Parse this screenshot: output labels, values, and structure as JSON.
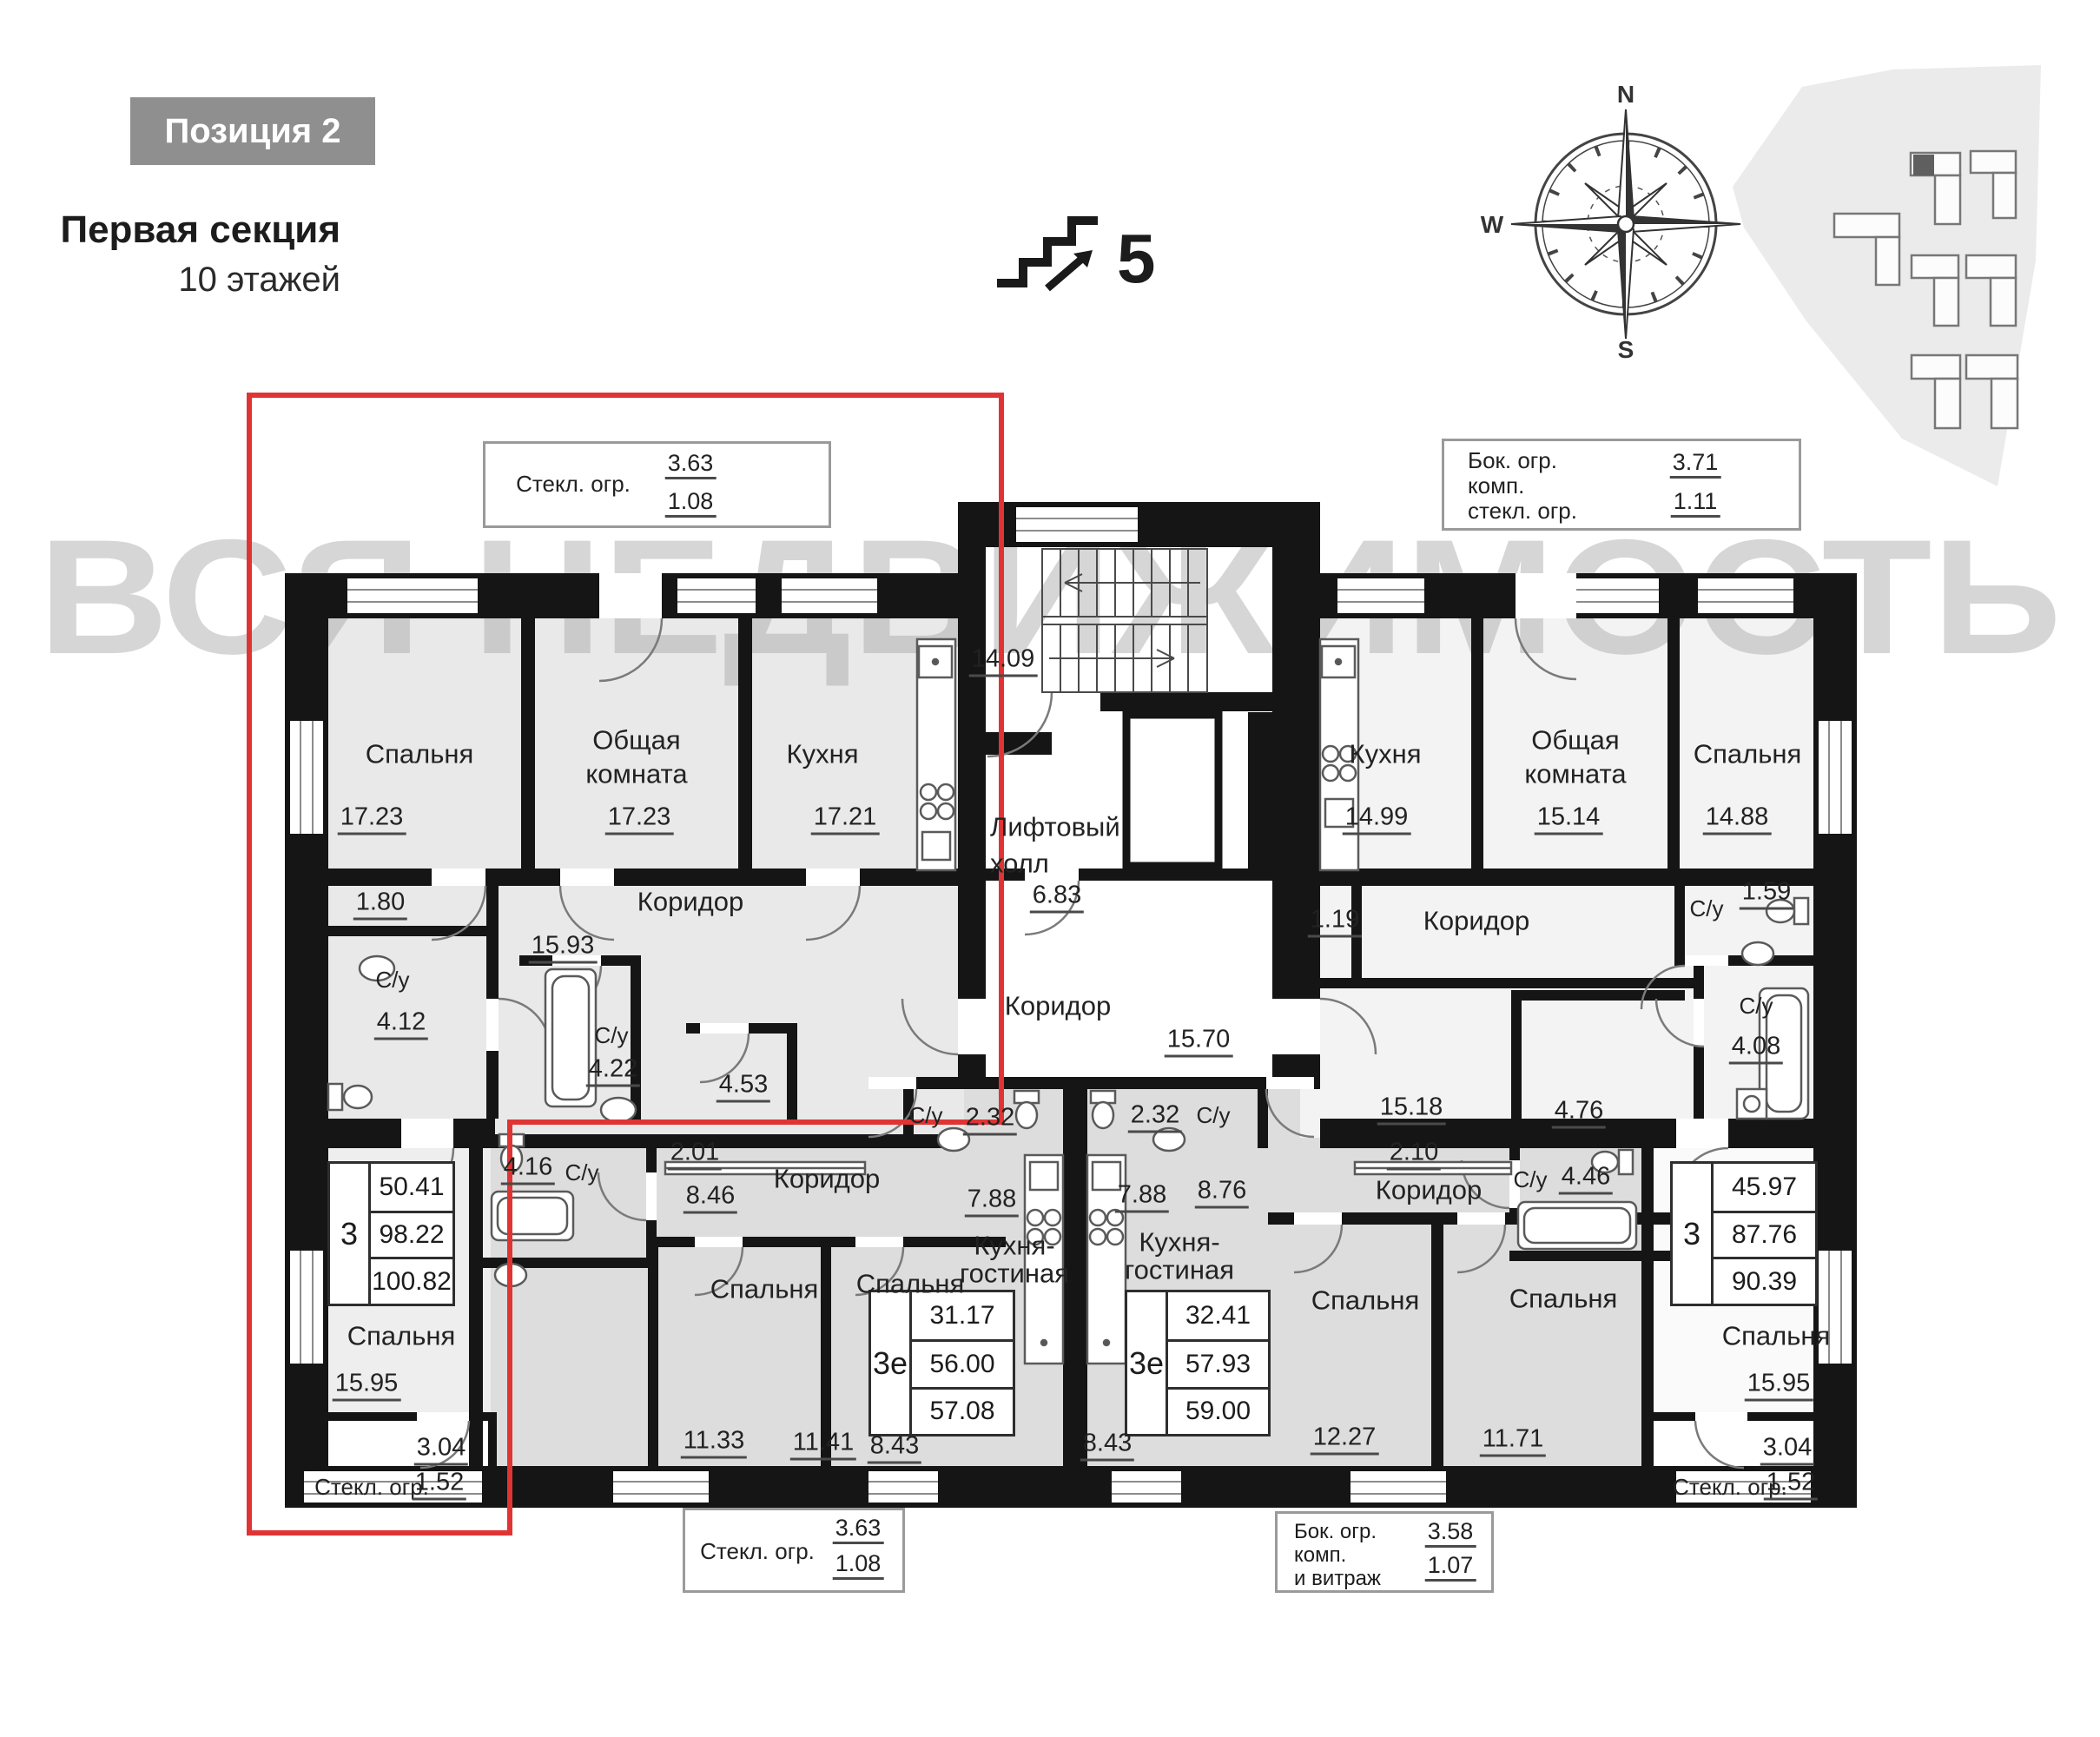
{
  "header": {
    "badge": "Позиция 2",
    "title": "Первая секция",
    "subtitle": "10 этажей",
    "floor": "5"
  },
  "compass": {
    "n": "N",
    "e": "E",
    "s": "S",
    "w": "W"
  },
  "watermark": "ВСЯ НЕДВИЖИМОСТЬ",
  "balconies": {
    "top_left": {
      "label": "Стекл. огр.",
      "top": "3.63",
      "bottom": "1.08"
    },
    "top_right": {
      "l1": "Бок. огр.",
      "l2": "комп.",
      "l3": "стекл. огр.",
      "top": "3.71",
      "bottom": "1.11"
    },
    "bottom_left": {
      "label": "Стекл. огр.",
      "top": "3.63",
      "bottom": "1.08"
    },
    "bottom_right": {
      "l1": "Бок. огр.",
      "l2": "комп.",
      "l3": "и витраж",
      "top": "3.58",
      "bottom": "1.07"
    },
    "apt_left": {
      "area": "3.04",
      "label": "Стекл. огр.",
      "glazed": "1.52"
    },
    "apt_right": {
      "area": "3.04",
      "label": "Стекл. огр.",
      "glazed": "1.52"
    }
  },
  "core": {
    "stairs_area": "14.09",
    "lift1": "Лифтовый",
    "lift2": "холл",
    "hall_area": "6.83",
    "corridor": "Коридор",
    "corridor_area": "15.70"
  },
  "apt_tl": {
    "bedroom": "Спальня",
    "bedroom_area": "17.23",
    "common1": "Общая",
    "common2": "комната",
    "common_area": "17.23",
    "kitchen": "Кухня",
    "kitchen_area": "17.21",
    "closet_area": "1.80",
    "wc1": "С/у",
    "wc1_area": "4.12",
    "corridor": "Коридор",
    "corridor_area": "15.93",
    "wc2": "С/у",
    "wc2_area": "4.22",
    "storage_area": "4.53",
    "bedroom2": "Спальня",
    "bedroom2_area": "15.95"
  },
  "apt_tr": {
    "kitchen": "Кухня",
    "kitchen_area": "14.99",
    "common1": "Общая",
    "common2": "комната",
    "common_area": "15.14",
    "bedroom": "Спальня",
    "bedroom_area": "14.88",
    "closet_area": "1.19",
    "corridor": "Коридор",
    "wc1": "С/у",
    "wc1_area": "1.59",
    "wc2": "С/у",
    "wc2_area": "4.08",
    "hall_area": "15.18",
    "storage_area": "4.76",
    "wardrobe_area": "2.10",
    "bedroom2": "Спальня",
    "bedroom2_area": "15.95"
  },
  "apt_bl": {
    "wc1_area": "4.16",
    "wc1": "С/у",
    "hall_area": "2.01",
    "corridor": "Коридор",
    "corridor_area": "8.46",
    "wc2": "С/у",
    "wc2_area": "2.32",
    "bedroom1": "Спальня",
    "bedroom1_area": "11.33",
    "bedroom2": "Спальня",
    "bedroom2_area": "11.41",
    "kitchen1": "Кухня-",
    "kitchen2": "гостиная",
    "kitchen_area_top": "7.88",
    "kitchen_area_bottom": "8.43"
  },
  "apt_br": {
    "wc1_area": "2.32",
    "wc1": "С/у",
    "kitchen1": "Кухня-",
    "kitchen2": "гостиная",
    "kitchen_area_top": "7.88",
    "corridor_area_top": "8.76",
    "kitchen_area_bottom": "8.43",
    "corridor": "Коридор",
    "wc2": "С/у",
    "wc2_area": "4.46",
    "bedroom1": "Спальня",
    "bedroom1_area": "12.27",
    "bedroom2": "Спальня",
    "bedroom2_area": "11.71"
  },
  "tables": {
    "apt_tl": {
      "rooms": "3",
      "v1": "50.41",
      "v2": "98.22",
      "v3": "100.82"
    },
    "apt_bl": {
      "rooms": "3е",
      "v1": "31.17",
      "v2": "56.00",
      "v3": "57.08"
    },
    "apt_br": {
      "rooms": "3е",
      "v1": "32.41",
      "v2": "57.93",
      "v3": "59.00"
    },
    "apt_tr": {
      "rooms": "3",
      "v1": "45.97",
      "v2": "87.76",
      "v3": "90.39"
    }
  }
}
